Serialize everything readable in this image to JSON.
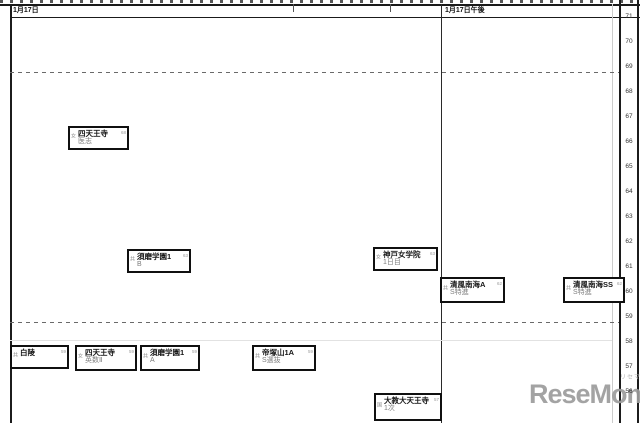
{
  "header": {
    "morning_label": "1月17日",
    "afternoon_label": "1月17日午後"
  },
  "watermark": {
    "text": "ReseMom.",
    "ruby": "リセマム"
  },
  "chart_data": {
    "type": "scatter",
    "description": "Entrance-exam schedule chart: school exam boxes placed by date column (x) and predicted deviation score (y)",
    "x_categories": [
      "1月17日",
      "1月17日午後"
    ],
    "y_axis": {
      "values": [
        71,
        70,
        69,
        68,
        67,
        66,
        65,
        64,
        63,
        62,
        61,
        60,
        59,
        58,
        57,
        56
      ],
      "dashed_values": [
        70,
        60
      ]
    },
    "legend_position": "none",
    "grid": "sparse",
    "points": [
      {
        "school": "四天王寺",
        "course": "医志",
        "session": "1月17日",
        "value": 68,
        "marker": "女",
        "x": 68,
        "y": 126,
        "w": 61,
        "h": 24
      },
      {
        "school": "須磨学園1",
        "course": "B",
        "session": "1月17日",
        "value": 63,
        "marker": "共",
        "x": 127,
        "y": 249,
        "w": 64,
        "h": 24
      },
      {
        "school": "神戸女学院",
        "course": "1日目",
        "session": "1月17日",
        "value": 63,
        "marker": "女",
        "x": 373,
        "y": 247,
        "w": 65,
        "h": 24
      },
      {
        "school": "清風南海A",
        "course": "S特進",
        "session": "1月17日午後",
        "value": 62,
        "marker": "共",
        "x": 440,
        "y": 277,
        "w": 65,
        "h": 26
      },
      {
        "school": "清風南海SS",
        "course": "S特進",
        "session": "1月17日午後",
        "value": 62,
        "marker": "共",
        "x": 563,
        "y": 277,
        "w": 62,
        "h": 26
      },
      {
        "school": "白陵",
        "course": "",
        "session": "1月17日",
        "value": 59,
        "marker": "共",
        "x": 10,
        "y": 345,
        "w": 59,
        "h": 24
      },
      {
        "school": "四天王寺",
        "course": "英数Ⅱ",
        "session": "1月17日",
        "value": 59,
        "marker": "女",
        "x": 75,
        "y": 345,
        "w": 62,
        "h": 26
      },
      {
        "school": "須磨学園1",
        "course": "A",
        "session": "1月17日",
        "value": 59,
        "marker": "共",
        "x": 140,
        "y": 345,
        "w": 60,
        "h": 26
      },
      {
        "school": "帝塚山1A",
        "course": "S選抜",
        "session": "1月17日",
        "value": 59,
        "marker": "共",
        "x": 252,
        "y": 345,
        "w": 64,
        "h": 26
      },
      {
        "school": "大教大天王寺",
        "course": "1次",
        "session": "1月17日",
        "value": 57,
        "marker": "国",
        "x": 374,
        "y": 393,
        "w": 68,
        "h": 28
      }
    ]
  }
}
